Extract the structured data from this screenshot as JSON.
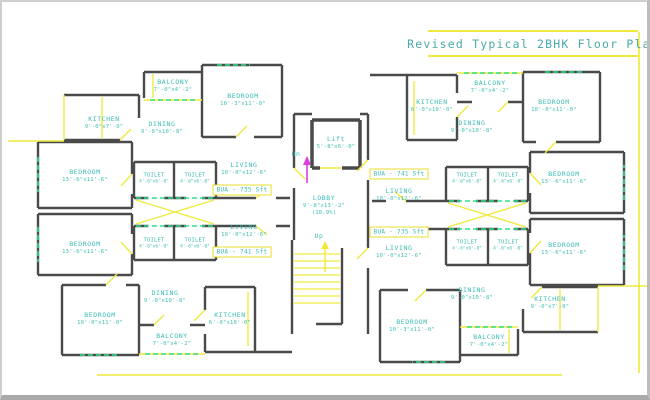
{
  "title": "Revised Typical 2BHK Floor Plan",
  "colors": {
    "wall": "#4a4a4a",
    "accent_yellow": "#efe93e",
    "label_teal": "#3bbcb4",
    "window_green": "#2ee08a",
    "arrow_magenta": "#e03ce0"
  },
  "center": {
    "lift": {
      "name": "Lift",
      "dims": "5'-8\"x6'-0\""
    },
    "lobby": {
      "name": "LOBBY",
      "dims": "9'-8\"x13'-2\"",
      "pct": "(10.9%)"
    },
    "dn": "Dn",
    "up": "Up"
  },
  "bua": [
    "BUA - 735 Sft",
    "BUA - 741 Sft",
    "BUA - 741 Sft",
    "BUA - 735 Sft"
  ],
  "rooms": [
    {
      "name": "KITCHEN",
      "dims": "9'-0\"x7'-0\""
    },
    {
      "name": "BALCONY",
      "dims": "7'-0\"x4'-2\""
    },
    {
      "name": "BEDROOM",
      "dims": "10'-3\"x11'-0\""
    },
    {
      "name": "DINING",
      "dims": "9'-0\"x10'-8\""
    },
    {
      "name": "BEDROOM",
      "dims": "13'-6\"x11'-6\""
    },
    {
      "name": "TOILET",
      "dims": "4'-6\"x6'-0\""
    },
    {
      "name": "TOILET",
      "dims": "4'-6\"x6'-0\""
    },
    {
      "name": "LIVING",
      "dims": "10'-0\"x12'-6\""
    },
    {
      "name": "BEDROOM",
      "dims": "13'-6\"x11'-6\""
    },
    {
      "name": "TOILET",
      "dims": "4'-6\"x6'-0\""
    },
    {
      "name": "TOILET",
      "dims": "4'-6\"x6'-0\""
    },
    {
      "name": "LIVING",
      "dims": "10'-0\"x12'-6\""
    },
    {
      "name": "DINING",
      "dims": "9'-0\"x10'-8\""
    },
    {
      "name": "BEDROOM",
      "dims": "10'-0\"x11'-0\""
    },
    {
      "name": "KITCHEN",
      "dims": "6'-0\"x10'-0\""
    },
    {
      "name": "BALCONY",
      "dims": "7'-0\"x4'-2\""
    },
    {
      "name": "BALCONY",
      "dims": "7'-0\"x4'-2\""
    },
    {
      "name": "KITCHEN",
      "dims": "6'-0\"x10'-0\""
    },
    {
      "name": "DINING",
      "dims": "9'-0\"x10'-8\""
    },
    {
      "name": "BEDROOM",
      "dims": "10'-0\"x11'-0\""
    },
    {
      "name": "TOILET",
      "dims": "4'-6\"x6'-0\""
    },
    {
      "name": "TOILET",
      "dims": "4'-6\"x6'-0\""
    },
    {
      "name": "LIVING",
      "dims": "10'-0\"x12'-6\""
    },
    {
      "name": "BEDROOM",
      "dims": "13'-6\"x11'-6\""
    },
    {
      "name": "TOILET",
      "dims": "4'-6\"x6'-0\""
    },
    {
      "name": "TOILET",
      "dims": "4'-6\"x6'-0\""
    },
    {
      "name": "LIVING",
      "dims": "10'-0\"x12'-6\""
    },
    {
      "name": "BEDROOM",
      "dims": "13'-6\"x11'-6\""
    },
    {
      "name": "DINING",
      "dims": "9'-0\"x10'-8\""
    },
    {
      "name": "BEDROOM",
      "dims": "10'-3\"x11'-0\""
    },
    {
      "name": "BALCONY",
      "dims": "7'-0\"x4'-2\""
    },
    {
      "name": "KITCHEN",
      "dims": "9'-0\"x7'-0\""
    }
  ]
}
